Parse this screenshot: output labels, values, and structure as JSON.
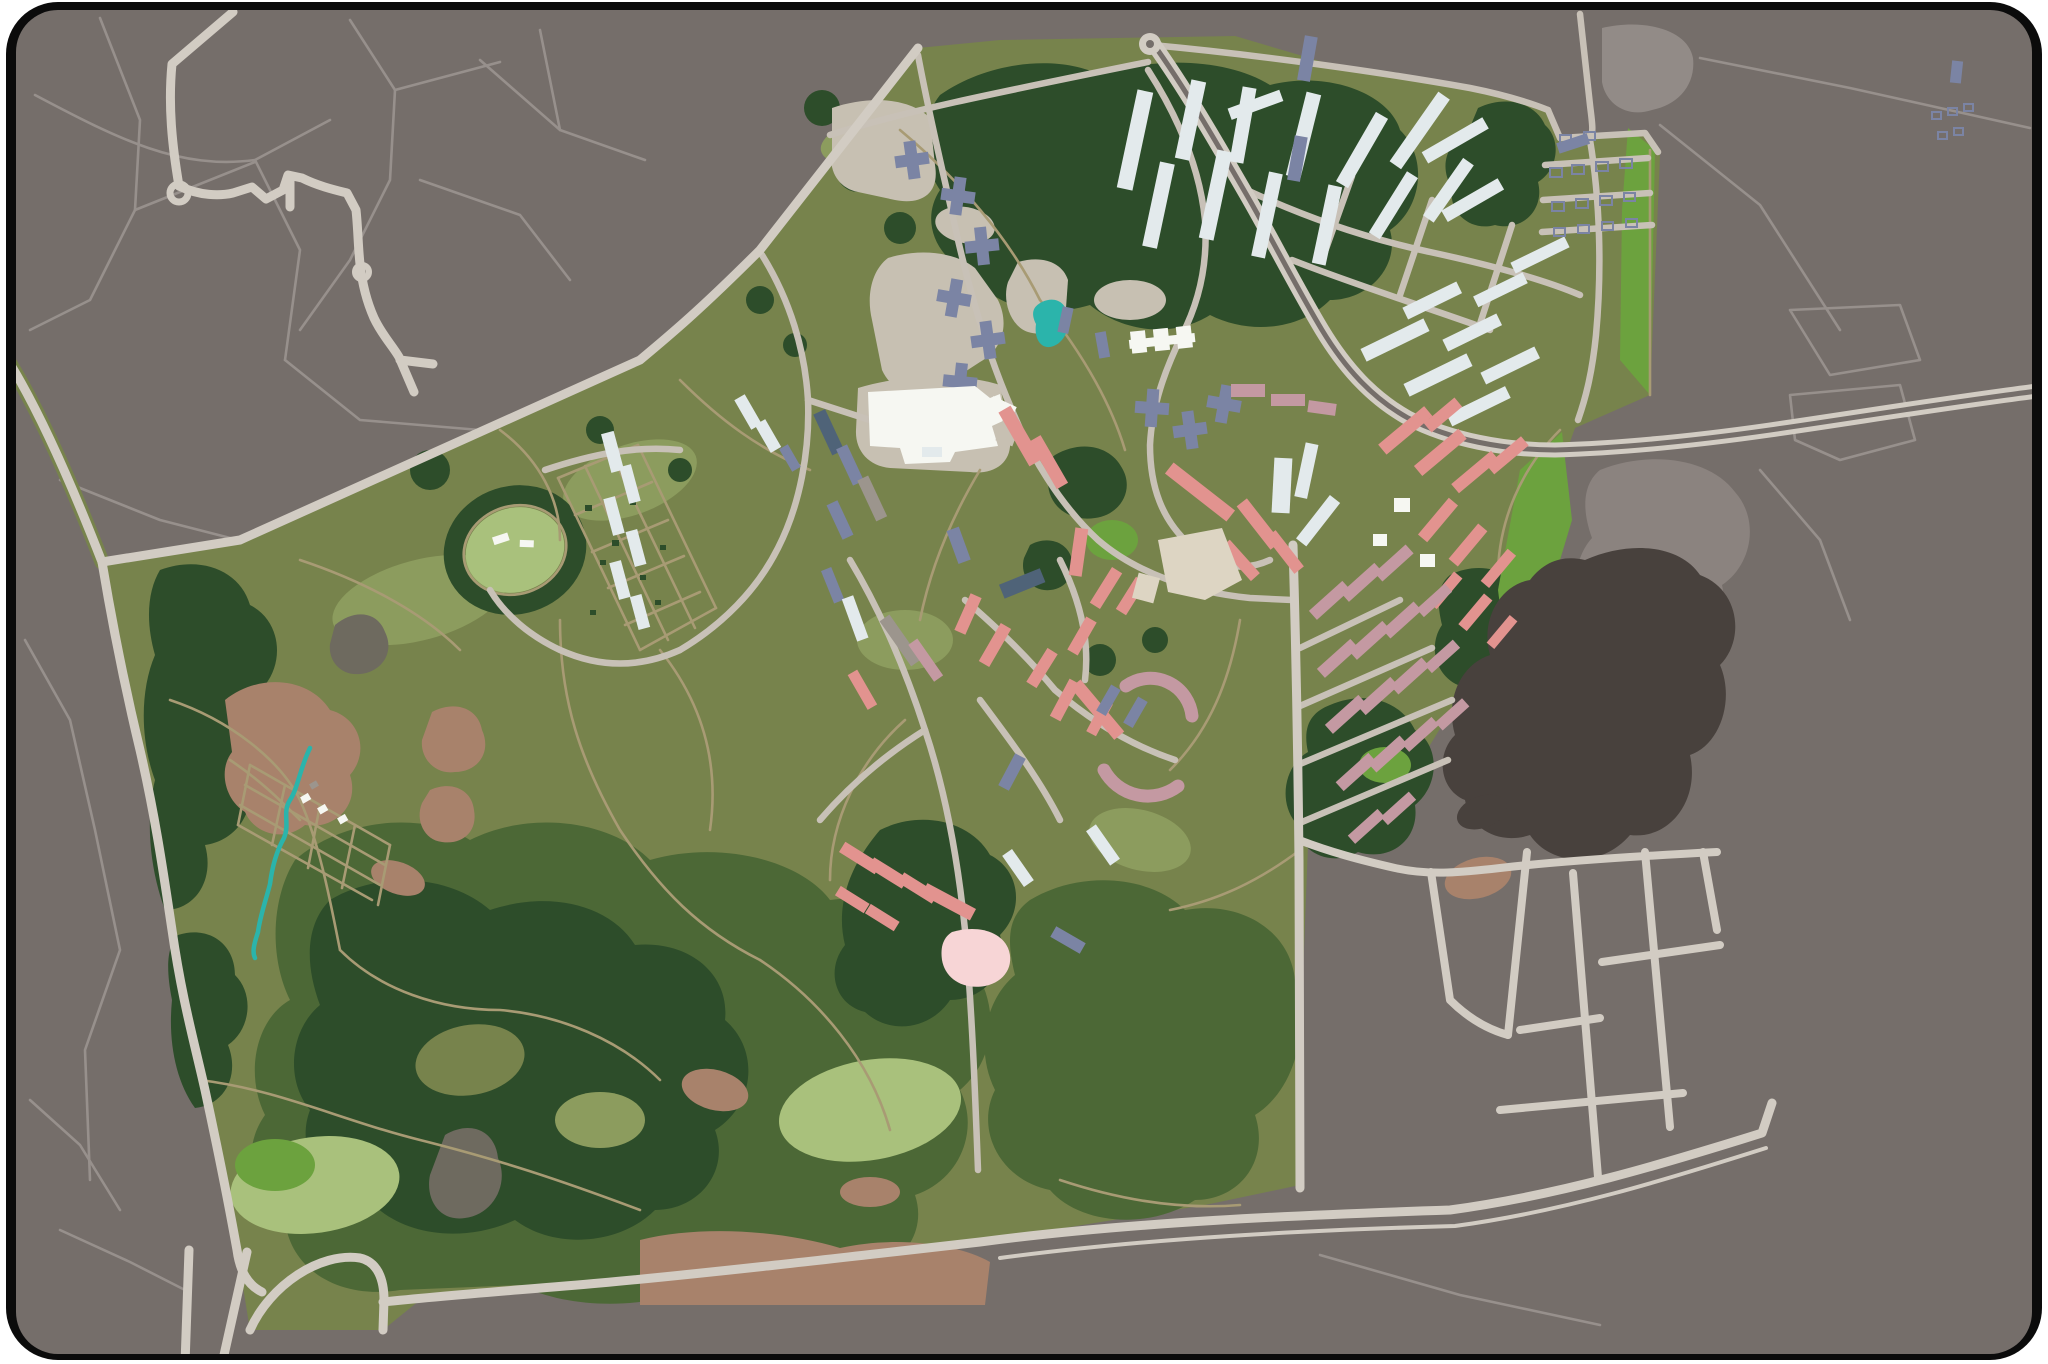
{
  "map": {
    "kind": "illustrated-district-plan",
    "palette": {
      "page_bg": "#FFFFFF",
      "frame": "#0B0B0B",
      "urban": "#756E6A",
      "urban_light": "#8B837F",
      "lot_light": "#928B87",
      "quarry_dark": "#48413D",
      "patch_gray": "#6E6A5F",
      "road_major": "#D2CCC3",
      "road_minor": "#C8C1B7",
      "path_faint": "#97908C",
      "path_tan": "#A89B74",
      "park": "#77834C",
      "park_light": "#8C9C5E",
      "forest_mid": "#4C6836",
      "forest_dark": "#2D4D2A",
      "meadow_pale": "#A9C17C",
      "meadow_bright": "#6CA23E",
      "clearing": "#A8826B",
      "paved": "#C7C0B2",
      "bldg_white": "#F6F7F2",
      "bldg_pale": "#E3EAEC",
      "bldg_pink": "#E2938F",
      "bldg_mauve": "#C499A2",
      "bldg_blue": "#7B84A4",
      "bldg_slate": "#4F6378",
      "bldg_gray": "#9C958D",
      "bldg_cream": "#DDD5C3",
      "water_teal": "#2BB4AB",
      "pond_pink": "#F7D5D6"
    },
    "legend": [
      {
        "feature": "surrounding urban fabric",
        "color_key": "urban"
      },
      {
        "feature": "district parkland",
        "color_key": "park"
      },
      {
        "feature": "dense forest",
        "color_key": "forest_dark"
      },
      {
        "feature": "mixed woods",
        "color_key": "forest_mid"
      },
      {
        "feature": "open meadow",
        "color_key": "meadow_pale"
      },
      {
        "feature": "bright field strip",
        "color_key": "meadow_bright"
      },
      {
        "feature": "bare clearings",
        "color_key": "clearing"
      },
      {
        "feature": "paved campus plaza",
        "color_key": "paved"
      },
      {
        "feature": "major roads",
        "color_key": "road_major"
      },
      {
        "feature": "local streets",
        "color_key": "road_minor"
      },
      {
        "feature": "park trails",
        "color_key": "path_tan"
      },
      {
        "feature": "white institutional buildings",
        "color_key": "bldg_white"
      },
      {
        "feature": "pale residential slabs",
        "color_key": "bldg_pale"
      },
      {
        "feature": "pink housing rows",
        "color_key": "bldg_pink"
      },
      {
        "feature": "mauve housing rows",
        "color_key": "bldg_mauve"
      },
      {
        "feature": "blue-gray blocks",
        "color_key": "bldg_blue"
      },
      {
        "feature": "allotment garden sheds",
        "color_key": "bldg_blue"
      },
      {
        "feature": "quarry / excavation",
        "color_key": "quarry_dark"
      },
      {
        "feature": "pond and stream",
        "color_key": "water_teal"
      },
      {
        "feature": "shallow pink pond",
        "color_key": "pond_pink"
      },
      {
        "feature": "racecourse ring",
        "color_key": "path_tan"
      }
    ]
  }
}
